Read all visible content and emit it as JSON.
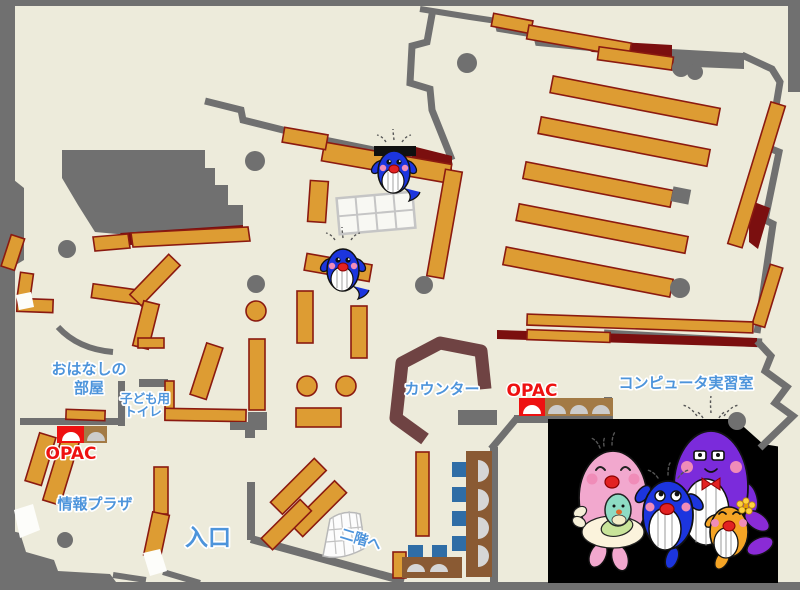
{
  "title": "library-first-floor-map",
  "labels": {
    "ohanashi_line1": "おはなしの",
    "ohanashi_line2": "部屋",
    "kodomo_toilet_line1": "子ども用",
    "kodomo_toilet_line2": "トイレ",
    "opac_left": "OPAC",
    "joho_plaza": "情報プラザ",
    "entrance": "入口",
    "to_second_floor": "二階へ",
    "counter": "カウンター",
    "opac_right": "OPAC",
    "computer_room": "コンピュータ実習室"
  },
  "mascots": {
    "floor_mascot_1": "blue-whale-mascot",
    "floor_mascot_2": "blue-whale-mascot",
    "panel": [
      "pink-whale-mother",
      "teal-whale-baby",
      "blue-whale-child",
      "purple-whale-father",
      "orange-whale-child"
    ]
  },
  "colors": {
    "floor_cream": "#edebdb",
    "wall_gray": "#707070",
    "shelf_orange": "#dd9c33",
    "shelf_border": "#8b1a10",
    "dark_red": "#7b0f0f",
    "counter_brown": "#6f4343",
    "desk_brown": "#8a5a33",
    "chair_blue": "#2f6da6",
    "label_blue": "#4d94db",
    "opac_red": "#ee1111",
    "panel_black": "#000000",
    "whale_blue": "#1c35de",
    "whale_pink": "#f2a8ce",
    "whale_purple": "#7b2bdb",
    "whale_orange": "#f5a425"
  }
}
